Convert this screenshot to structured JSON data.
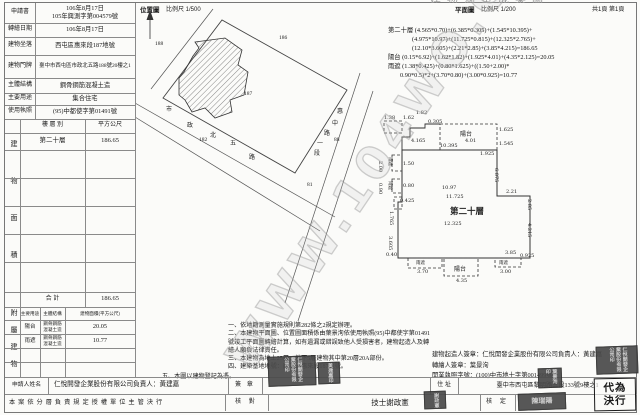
{
  "header": {
    "doc_title": "建物測量成果圖",
    "sheet_label": "共1頁 第1頁",
    "location_map_title": "位置圖",
    "location_map_scale": "比例尺 1/500",
    "floor_plan_title": "平面圖",
    "floor_plan_scale": "比例尺 1/200"
  },
  "watermark": {
    "text": "WWW.104WO.COM"
  },
  "info_table": {
    "rows": [
      {
        "label": "申請書",
        "value": "106年8月17日\n105年興測字第004579號"
      },
      {
        "label": "轉繪日期",
        "value": "106年8月17日"
      },
      {
        "label": "建物坐落",
        "value": "西屯區惠來段187地號"
      },
      {
        "label": "建物門牌",
        "value": "臺中市西屯區市政北五路188號20樓之1"
      },
      {
        "label": "主體結構",
        "value": "鋼骨鋼筋混凝土造"
      },
      {
        "label": "主要用途",
        "value": "集合住宅"
      },
      {
        "label": "使用執照",
        "value": "(95)中都使字第01491號"
      }
    ]
  },
  "area_table": {
    "section_label": "建物面積",
    "col_floor": "樓 層 別",
    "col_area": "平方公尺",
    "rows": [
      {
        "floor": "第二十層",
        "area": "186.65"
      }
    ],
    "total_label": "合  計",
    "total_area": "186.65"
  },
  "attached_table": {
    "section_label": "附屬建物",
    "col_use": "主要用途",
    "col_structure": "主體結構",
    "col_area": "建物面積(平方公尺)",
    "rows": [
      {
        "use": "陽台",
        "structure": "鋼骨鋼筋\n混凝土造",
        "area": "20.05"
      },
      {
        "use": "雨遮",
        "structure": "鋼骨鋼筋\n混凝土造",
        "area": "10.77"
      }
    ]
  },
  "calculations": {
    "lines": [
      "第二十層 (4.565*0.70)+(6.385*0.305)+(1.545*10.395)+",
      "(4.975*10.97)+(11.725*0.815)+(12.325*2.765)+",
      "(12.10*3.605)+(2.21*2.85)+(3.85*4.215)=186.65",
      "陽台 (0.15*6.92)+(1.62*1.82)+(1.925*4.01)+(4.35*2.125)=20.05",
      "雨遮 (1.38*0.425)+(0.80*1.625)+((1.50+2.00)*",
      "0.90*0.5)*2+(3.70*0.80)+(3.00*0.925)=10.77"
    ]
  },
  "notes": {
    "lines": [
      "一、依地籍測量實施規則第282條之2規定辦理。",
      "二、本建物平面圖、位置圖面積係由葉景洵依使用執照(95)中都使字第01491號竣工平面圖轉繪計算，如有遺漏或錯誤致他人受損害者，建物起造人及轉繪人願負法律責任。",
      "三、本建物為地上25層、地下5層建物其中第20層20A部份。",
      "四、建築基地地號：西屯區惠來段187地號。",
      "五、本圖以建物登記為憑。"
    ]
  },
  "signature_block": {
    "builder": "建物起造人簽章：仁悅開發企業股份有限公司負責人：黃建嘉",
    "transcriber": "轉繪人簽章：葉景洵",
    "license": "開業執照字號：(100)中市地士字第001499號"
  },
  "applicant_row": {
    "label": "申請人姓名",
    "value": "仁悅開發企業股份有限公司負責人：黃建嘉",
    "sign_label": "簽 章",
    "addr_label": "住 址",
    "addr_value": "臺中市西屯區黎明路三段133號9樓之1"
  },
  "approval_row": {
    "delegation": "本案依分層負責規定授權單位主管決行",
    "check_label": "核 對",
    "technician": "技士謝政憲",
    "approve_label": "核 定",
    "deputy": "代為決行"
  },
  "stamps": [
    {
      "text": "仁悅開發企業股份有限公司印"
    },
    {
      "text": "黃建嘉印"
    },
    {
      "text": "謝政憲"
    },
    {
      "text": "仁悅開發企業股份有限公司印"
    },
    {
      "text": "葉景洵印"
    },
    {
      "text": "陳瑞陽"
    }
  ],
  "location_map": {
    "labels": [
      {
        "t": "188",
        "x": 20,
        "y": 38,
        "s": 5.5
      },
      {
        "t": "186",
        "x": 144,
        "y": 32,
        "s": 5.5
      },
      {
        "t": "187",
        "x": 109,
        "y": 88,
        "s": 5.5
      },
      {
        "t": "182",
        "x": 64,
        "y": 134,
        "s": 5.5
      },
      {
        "t": "88",
        "x": 199,
        "y": 134,
        "s": 5.5
      },
      {
        "t": "81",
        "x": 172,
        "y": 179,
        "s": 5.5
      },
      {
        "t": "市",
        "x": 31,
        "y": 101
      },
      {
        "t": "政",
        "x": 52,
        "y": 117
      },
      {
        "t": "北",
        "x": 75,
        "y": 127
      },
      {
        "t": "五",
        "x": 95,
        "y": 135
      },
      {
        "t": "路",
        "x": 114,
        "y": 149
      },
      {
        "t": "惠",
        "x": 202,
        "y": 103
      },
      {
        "t": "中",
        "x": 197,
        "y": 115
      },
      {
        "t": "路",
        "x": 189,
        "y": 125
      },
      {
        "t": "一",
        "x": 182,
        "y": 135
      },
      {
        "t": "段",
        "x": 179,
        "y": 145
      }
    ]
  },
  "floor_plan": {
    "unit_label": "第二十層",
    "labels": [
      {
        "t": "10.395",
        "x": 60,
        "y": 48
      },
      {
        "t": "陽台",
        "x": 80,
        "y": 34,
        "s": 6
      },
      {
        "t": "4.01",
        "x": 85,
        "y": 43
      },
      {
        "t": "1.625",
        "x": 119,
        "y": 32
      },
      {
        "t": "1.545",
        "x": 119,
        "y": 46
      },
      {
        "t": "1.925",
        "x": 100,
        "y": 56
      },
      {
        "t": "1.38",
        "x": 4,
        "y": 20
      },
      {
        "t": "1.62",
        "x": 23,
        "y": 20
      },
      {
        "t": "1.82",
        "x": 36,
        "y": 15
      },
      {
        "t": "0.305",
        "x": 48,
        "y": 24
      },
      {
        "t": "4.165",
        "x": 31,
        "y": 43
      },
      {
        "t": "雨遮",
        "x": 13,
        "y": 62,
        "r": 90,
        "s": 4.5
      },
      {
        "t": "2.00",
        "x": 3,
        "y": 66,
        "r": 90
      },
      {
        "t": "1.50",
        "x": 23,
        "y": 66
      },
      {
        "t": "雨遮",
        "x": 13,
        "y": 86,
        "r": 90,
        "s": 4.5
      },
      {
        "t": "0.90",
        "x": 3,
        "y": 88,
        "r": 90
      },
      {
        "t": "0.80",
        "x": 23,
        "y": 88
      },
      {
        "t": "0.425",
        "x": 20,
        "y": 103
      },
      {
        "t": "1.765",
        "x": 14,
        "y": 116,
        "r": 90
      },
      {
        "t": "3.605",
        "x": 13,
        "y": 141,
        "r": 90
      },
      {
        "t": "0.40",
        "x": 6,
        "y": 157
      },
      {
        "t": "10.97",
        "x": 62,
        "y": 90
      },
      {
        "t": "11.725",
        "x": 66,
        "y": 99
      },
      {
        "t": "第二十層",
        "x": 70,
        "y": 110,
        "s": 8.5,
        "b": 1
      },
      {
        "t": "12.325",
        "x": 64,
        "y": 126
      },
      {
        "t": "6.875",
        "x": 119,
        "y": 73,
        "r": 90
      },
      {
        "t": "2.21",
        "x": 126,
        "y": 94
      },
      {
        "t": "2.85",
        "x": 152,
        "y": 104,
        "r": 90
      },
      {
        "t": "4.215",
        "x": 152,
        "y": 128,
        "r": 90
      },
      {
        "t": "3.85",
        "x": 125,
        "y": 155
      },
      {
        "t": "雨遮",
        "x": 36,
        "y": 165,
        "s": 4.5
      },
      {
        "t": "3.70",
        "x": 37,
        "y": 174
      },
      {
        "t": "陽台",
        "x": 74,
        "y": 169,
        "s": 6
      },
      {
        "t": "4.35",
        "x": 76,
        "y": 183
      },
      {
        "t": "雨遮",
        "x": 119,
        "y": 165,
        "s": 4.5
      },
      {
        "t": "3.00",
        "x": 120,
        "y": 174
      },
      {
        "t": "0.925",
        "x": 140,
        "y": 158
      }
    ]
  }
}
